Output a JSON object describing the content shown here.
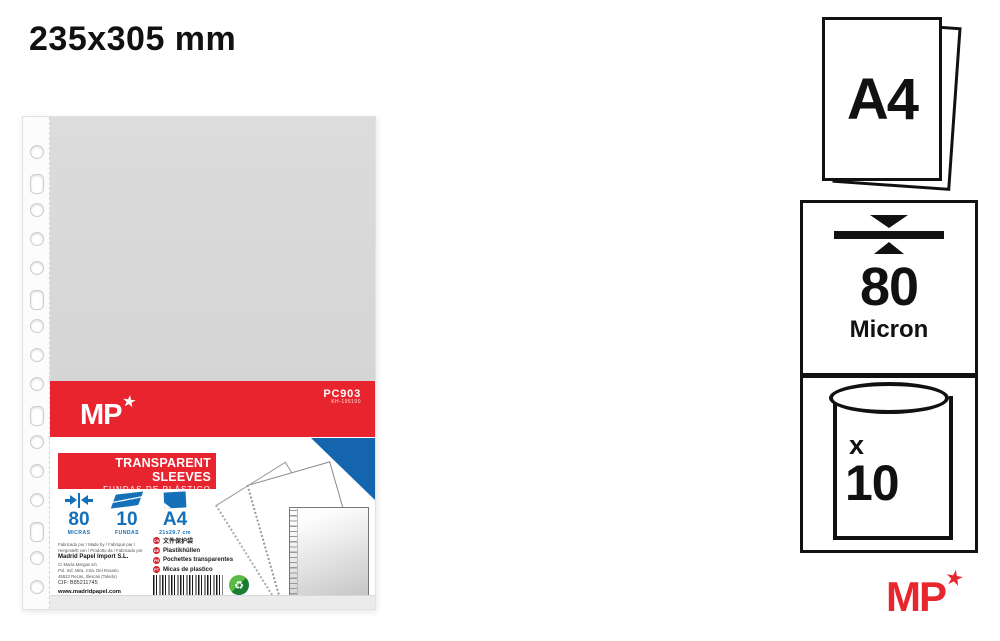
{
  "page": {
    "title": "235x305 mm"
  },
  "colors": {
    "accent_red": "#e8242e",
    "accent_blue": "#1470b8",
    "triangle_blue": "#1464ae",
    "logo_red": "#e8262d",
    "sleeve_gray": "#d9d9d9"
  },
  "product_label": {
    "brand": {
      "text": "MP",
      "star": "★"
    },
    "product_code": "PC903",
    "product_code_sub": "KH-195190",
    "title_en": "TRANSPARENT SLEEVES",
    "title_es": "FUNDAS DE PLÁSTICO",
    "title_it": "BUSTE A PERFORAZIONE",
    "specs": [
      {
        "icon": "thickness-icon",
        "value": "80",
        "unit": "MICRAS"
      },
      {
        "icon": "sleeves-stack-icon",
        "value": "10",
        "unit": "FUNDAS"
      },
      {
        "icon": "a4-sheet-icon",
        "value": "A4",
        "unit": "21x29.7 cm"
      }
    ],
    "languages": [
      {
        "code": "CN",
        "text": "文件保护袋"
      },
      {
        "code": "DE",
        "text": "Plastikhüllen"
      },
      {
        "code": "FR",
        "text": "Pochettes transparentes"
      },
      {
        "code": "PT",
        "text": "Micas de plastico"
      }
    ],
    "manufacturer": {
      "made_by_line1": "Fabricado por / Made by / Fabriqué par /",
      "made_by_line2": "Hergestellt von / Prodotto da / Fabricado por",
      "name": "Madrid Papel Import S.L.",
      "address1": "C/ María Margas s/n",
      "address2": "Pol. Ind. Mira. Crta. Del Rosario",
      "address3": "45523 Recas, Illescas (Toledo)",
      "cif": "CIF: B85211745",
      "web": "www.madridpapel.com",
      "footer_line": "Fabricado en China / Made in China / Fabriqué en Chine"
    },
    "barcode_digits": "8 435842 195190",
    "green_point_icon": "♻"
  },
  "badges": {
    "a4": {
      "label": "A4"
    },
    "micron": {
      "value": "80",
      "unit": "Micron"
    },
    "count": {
      "prefix": "x",
      "value": "10"
    }
  },
  "footer_logo": {
    "text": "MP",
    "star": "★"
  }
}
